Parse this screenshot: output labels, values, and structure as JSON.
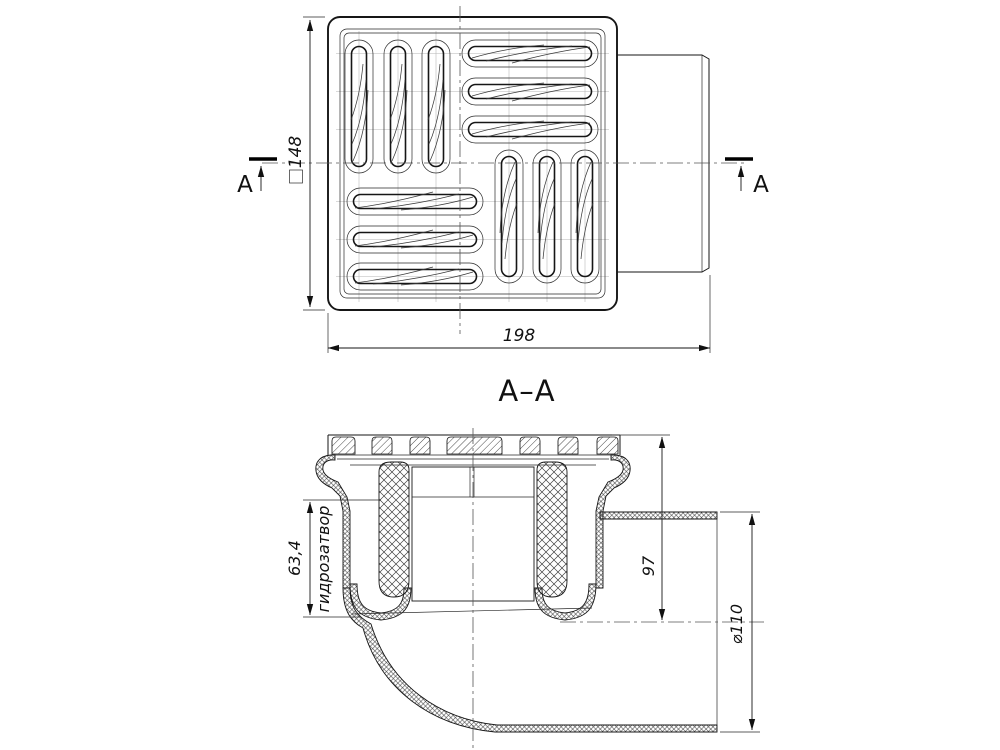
{
  "drawing": {
    "cut_marker": "A",
    "section_title": "A–A",
    "top_view": {
      "height_dim": "148",
      "width_dim": "198"
    },
    "section_view": {
      "seal_dim": "63,4",
      "seal_label": "гидрозатвор",
      "axis_dim": "97",
      "diameter_dim": "⌀110"
    }
  }
}
